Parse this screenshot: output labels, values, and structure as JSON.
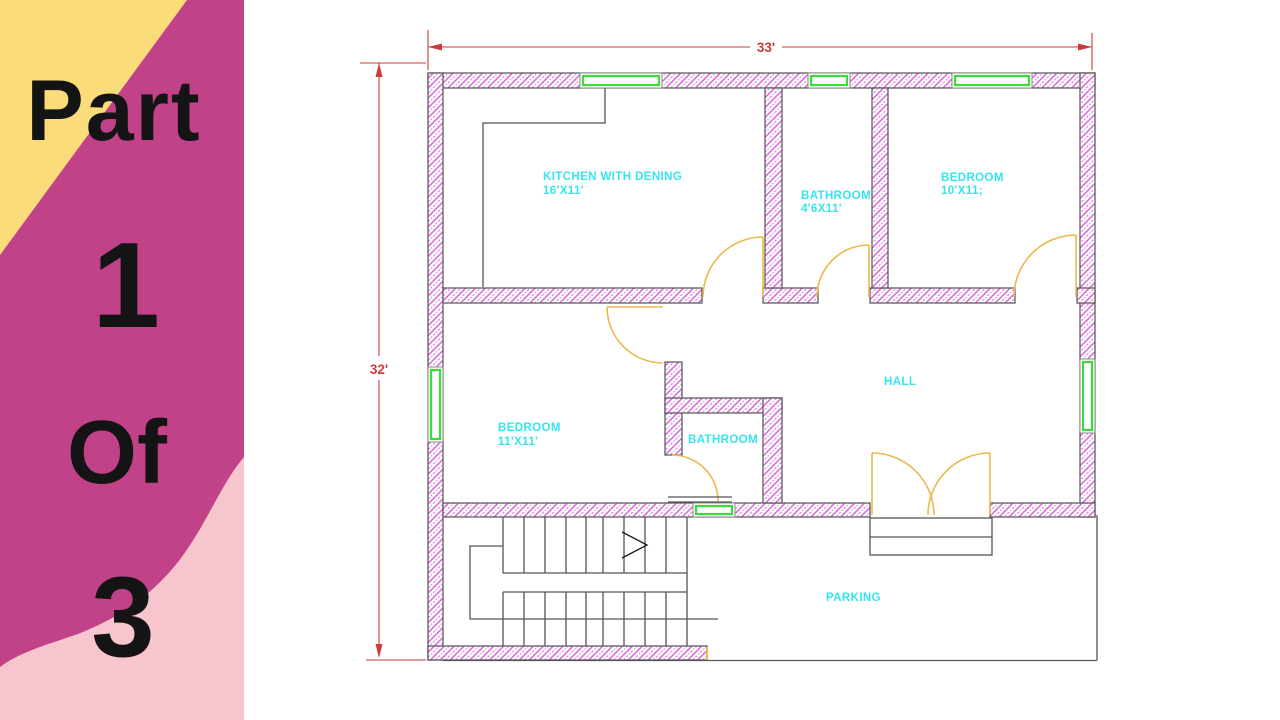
{
  "panel": {
    "word1": "Part",
    "word2": "1",
    "word3": "Of",
    "word4": "3",
    "colors": {
      "background": "#c2428a",
      "triangle": "#fbdc7a",
      "wave": "#f6c5cd",
      "text": "#141414"
    }
  },
  "plan": {
    "dimensions": {
      "width": "33'",
      "height": "32'"
    },
    "rooms": [
      {
        "name": "KITCHEN WITH DENING",
        "size": "16'X11'"
      },
      {
        "name": "BATHROOM",
        "size": "4'6X11'"
      },
      {
        "name": "BEDROOM",
        "size": "10'X11;"
      },
      {
        "name": "BEDROOM",
        "size": "11'X11'"
      },
      {
        "name": "BATHROOM",
        "size": ""
      },
      {
        "name": "HALL",
        "size": ""
      },
      {
        "name": "PARKING",
        "size": ""
      }
    ],
    "colors": {
      "wall_hatch": "#d55ad5",
      "wall_outline": "#5e5e5e",
      "window": "#3bdb3b",
      "door": "#ecb94d",
      "label": "#35e5ee",
      "dimension": "#cc3a3a"
    }
  }
}
